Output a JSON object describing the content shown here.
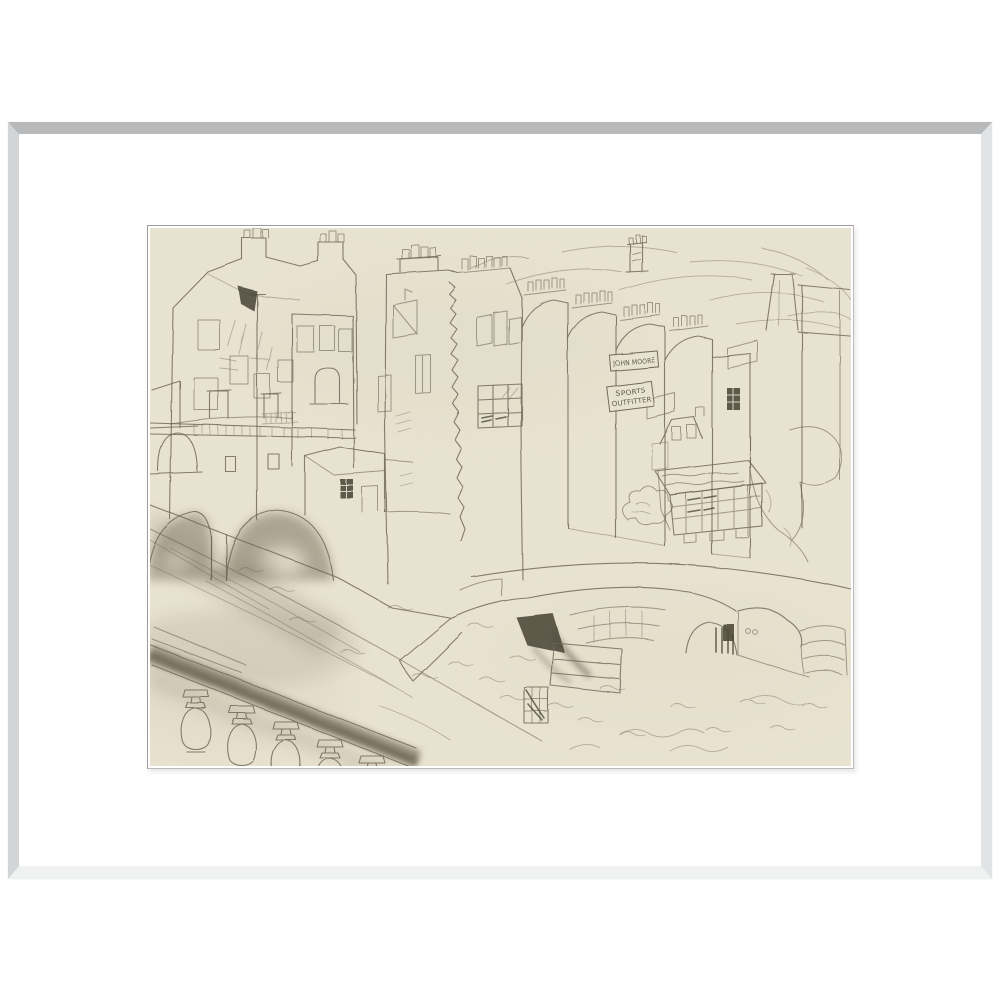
{
  "artwork": {
    "kind": "framed-pencil-drawing",
    "signs": {
      "shop_name": "JOHN MOORE",
      "trade_line1": "SPORTS",
      "trade_line2": "OUTFITTER"
    },
    "colors": {
      "page-bg": "#ffffff",
      "frame-top": "#b7b9bb",
      "frame-left": "#d3d4d5",
      "frame-right": "#e2e3e4",
      "frame-bottom": "#f0f1f1",
      "frame-face": "#ffffff",
      "mat": "#ffffff",
      "mat-bevel": "#9e9d99",
      "paper": "#e8e2d0",
      "pencil": "#6c6555",
      "pencil-dark": "#4f4a3c",
      "smudge": "#8f8876"
    }
  }
}
